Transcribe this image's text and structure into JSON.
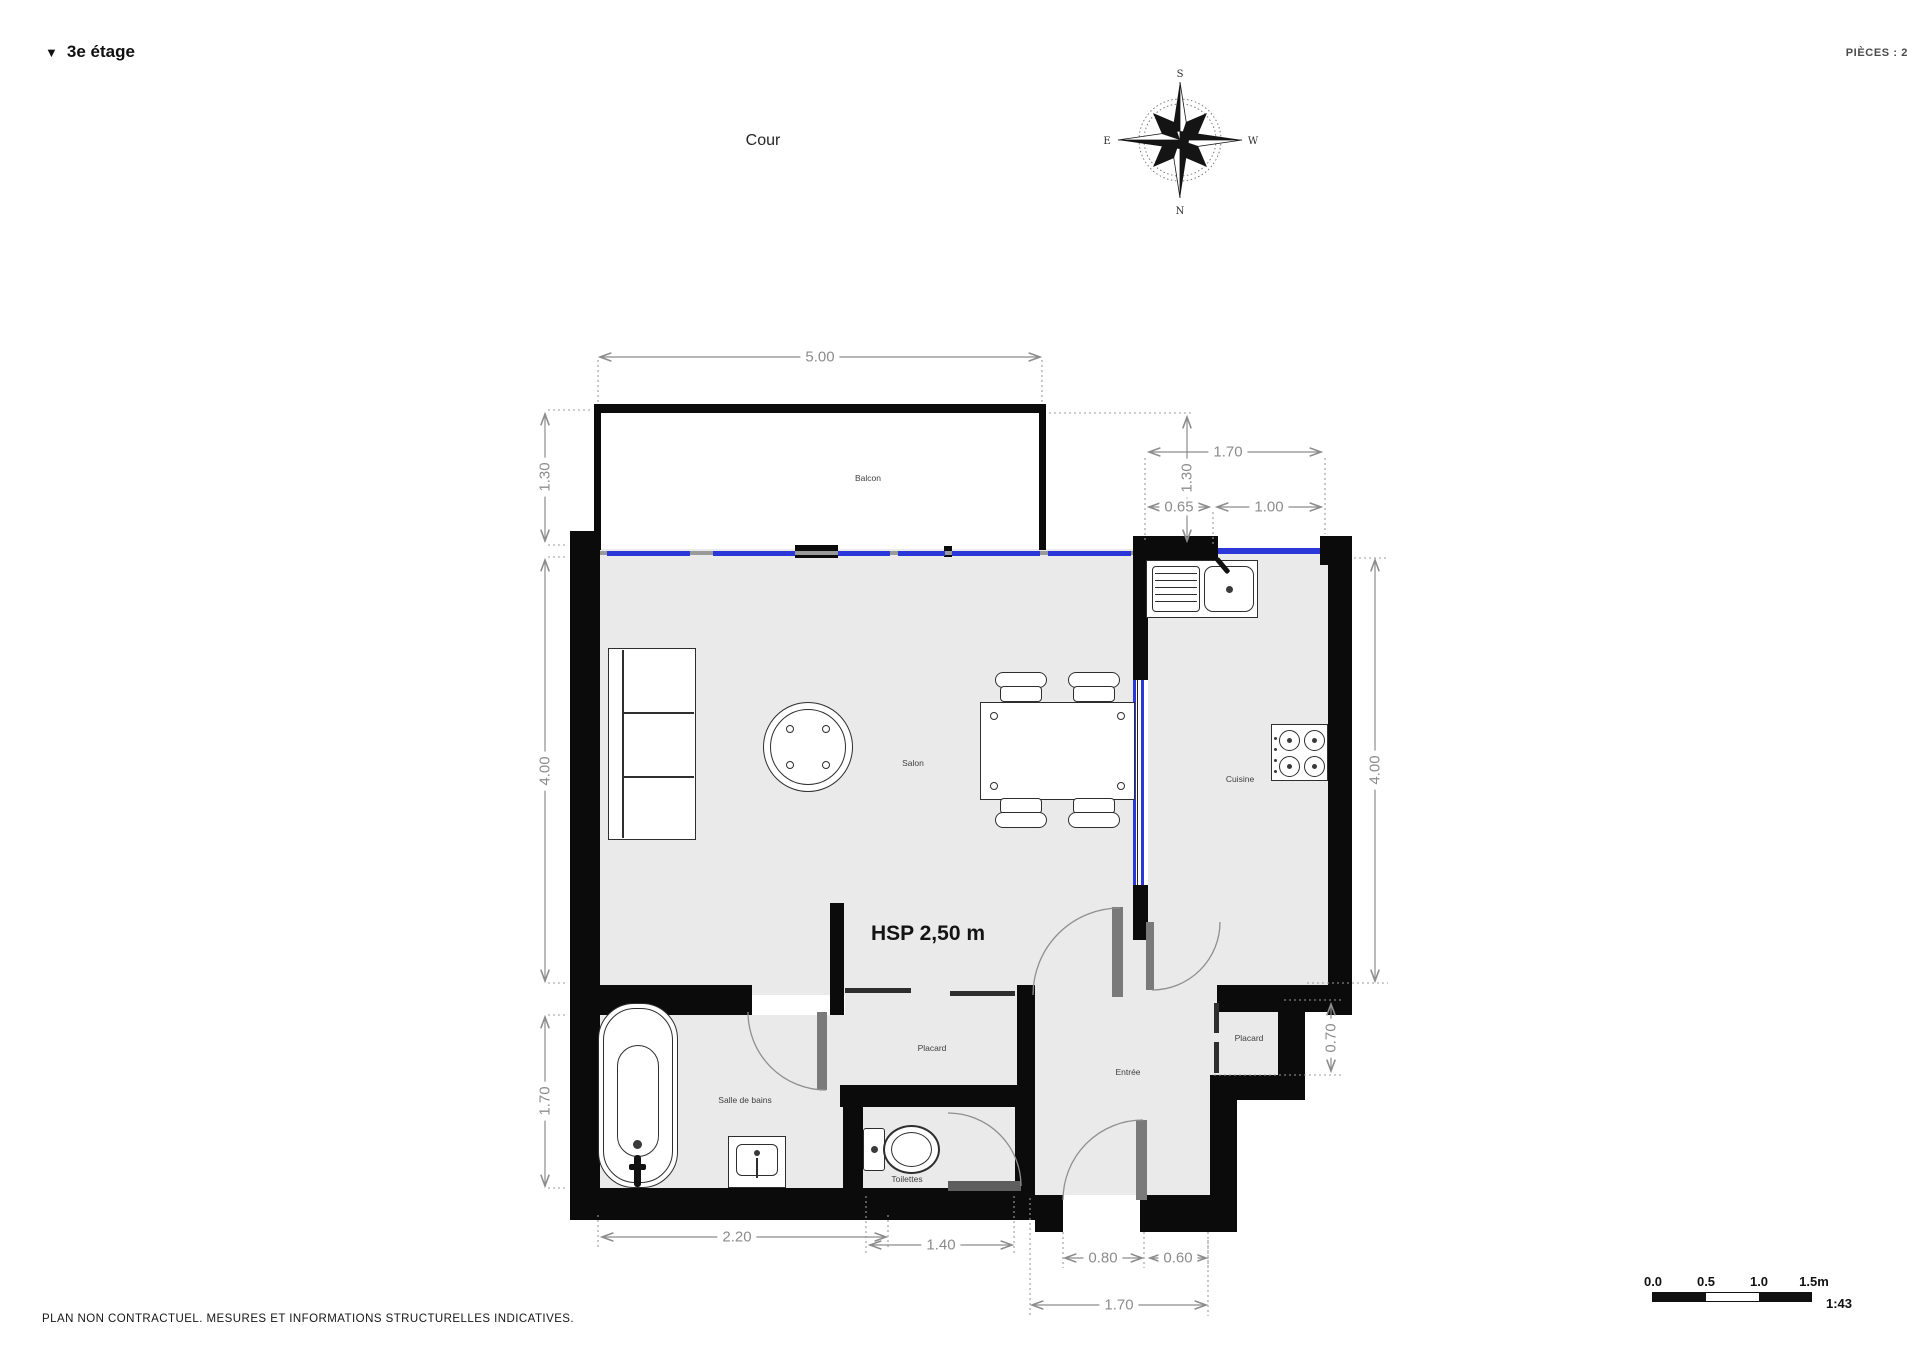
{
  "header": {
    "collapse_icon": "▼",
    "floor_label": "3e étage",
    "pieces_label": "PIÈCES : 2"
  },
  "context": {
    "courtyard_label": "Cour"
  },
  "compass": {
    "north": "N",
    "south": "S",
    "east": "E",
    "west": "W"
  },
  "rooms": {
    "balcony": "Balcon",
    "living": "Salon",
    "kitchen": "Cuisine",
    "bathroom": "Salle de bains",
    "toilet": "Toilettes",
    "entry": "Entrée",
    "closet_left": "Placard",
    "closet_right": "Placard"
  },
  "annotations": {
    "ceiling_height": "HSP 2,50 m"
  },
  "dims": {
    "top_width": "5.00",
    "left_balcony": "1.30",
    "left_salon": "4.00",
    "left_bath": "1.70",
    "right_top_width": "1.70",
    "right_balcony": "1.30",
    "offset_065": "0.65",
    "window_100": "1.00",
    "right_kitchen": "4.00",
    "closet_070": "0.70",
    "bottom_bath": "2.20",
    "bottom_toilet": "1.40",
    "bottom_door": "0.80",
    "bottom_wall": "0.60",
    "bottom_entry": "1.70"
  },
  "scale_bar": {
    "tick_0": "0.0",
    "tick_1": "0.5",
    "tick_2": "1.0",
    "tick_3": "1.5m",
    "ratio": "1:43"
  },
  "footer": {
    "disclaimer": "PLAN NON CONTRACTUEL. MESURES ET INFORMATIONS STRUCTURELLES INDICATIVES."
  }
}
